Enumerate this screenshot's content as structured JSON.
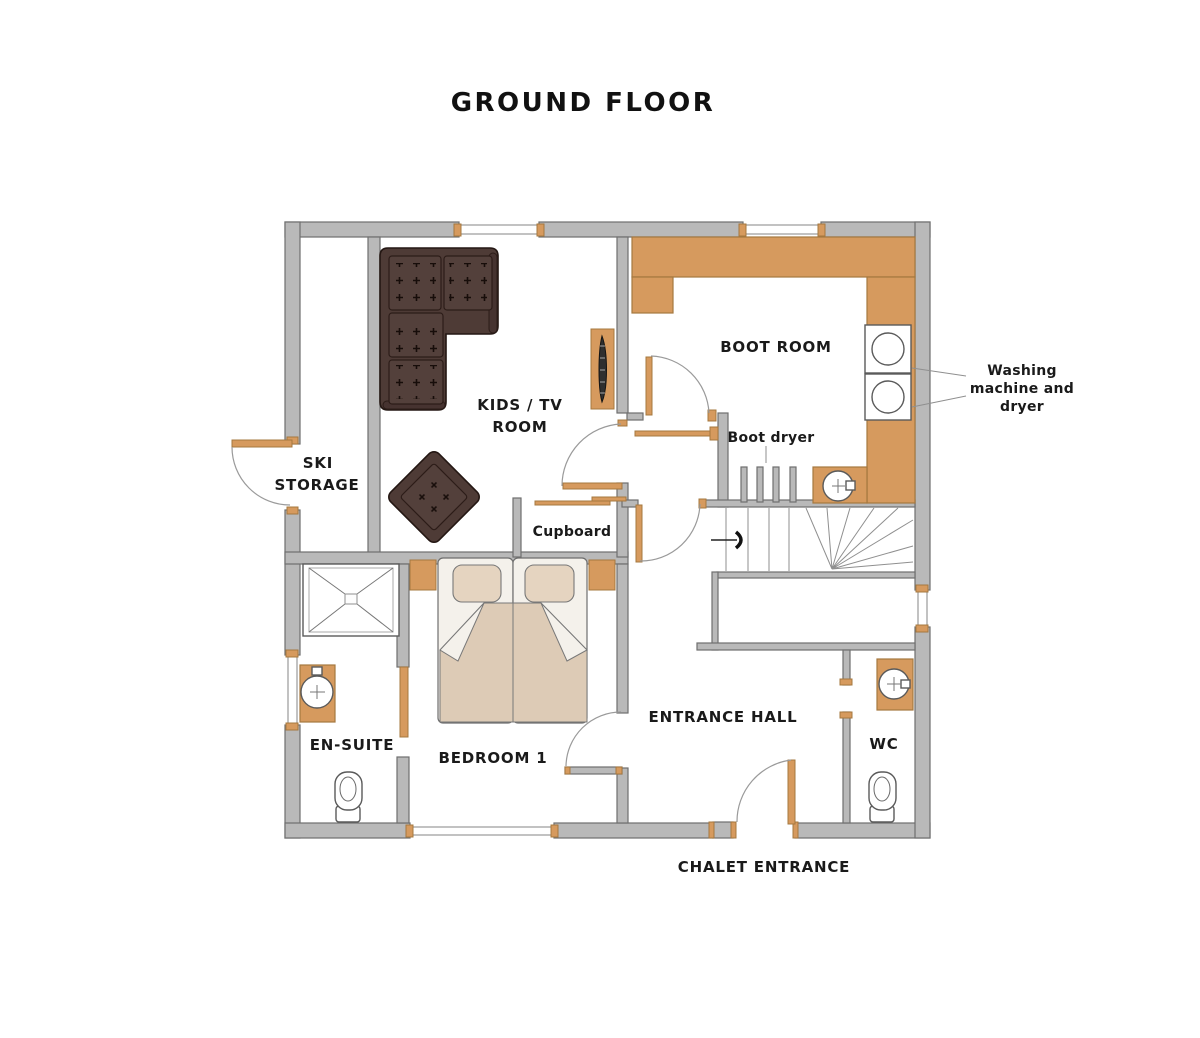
{
  "title": "GROUND FLOOR",
  "labels": {
    "ski_storage_1": "SKI",
    "ski_storage_2": "STORAGE",
    "kids_tv_1": "KIDS / TV",
    "kids_tv_2": "ROOM",
    "boot_room": "BOOT ROOM",
    "boot_dryer": "Boot dryer",
    "washing_1": "Washing",
    "washing_2": "machine and",
    "washing_3": "dryer",
    "cupboard": "Cupboard",
    "bedroom": "BEDROOM 1",
    "ensuite": "EN-SUITE",
    "entrance_hall": "ENTRANCE HALL",
    "wc": "WC",
    "chalet_entrance": "CHALET ENTRANCE"
  },
  "colors": {
    "wall": "#b9b9b9",
    "wall_stroke": "#6f6f6f",
    "wood": "#d69a5e",
    "sofa": "#4e3b36",
    "duvet": "#ddcbb6",
    "pillow": "#e5d4c0",
    "linen": "#f4f1eb",
    "text": "#1a1a1a"
  }
}
